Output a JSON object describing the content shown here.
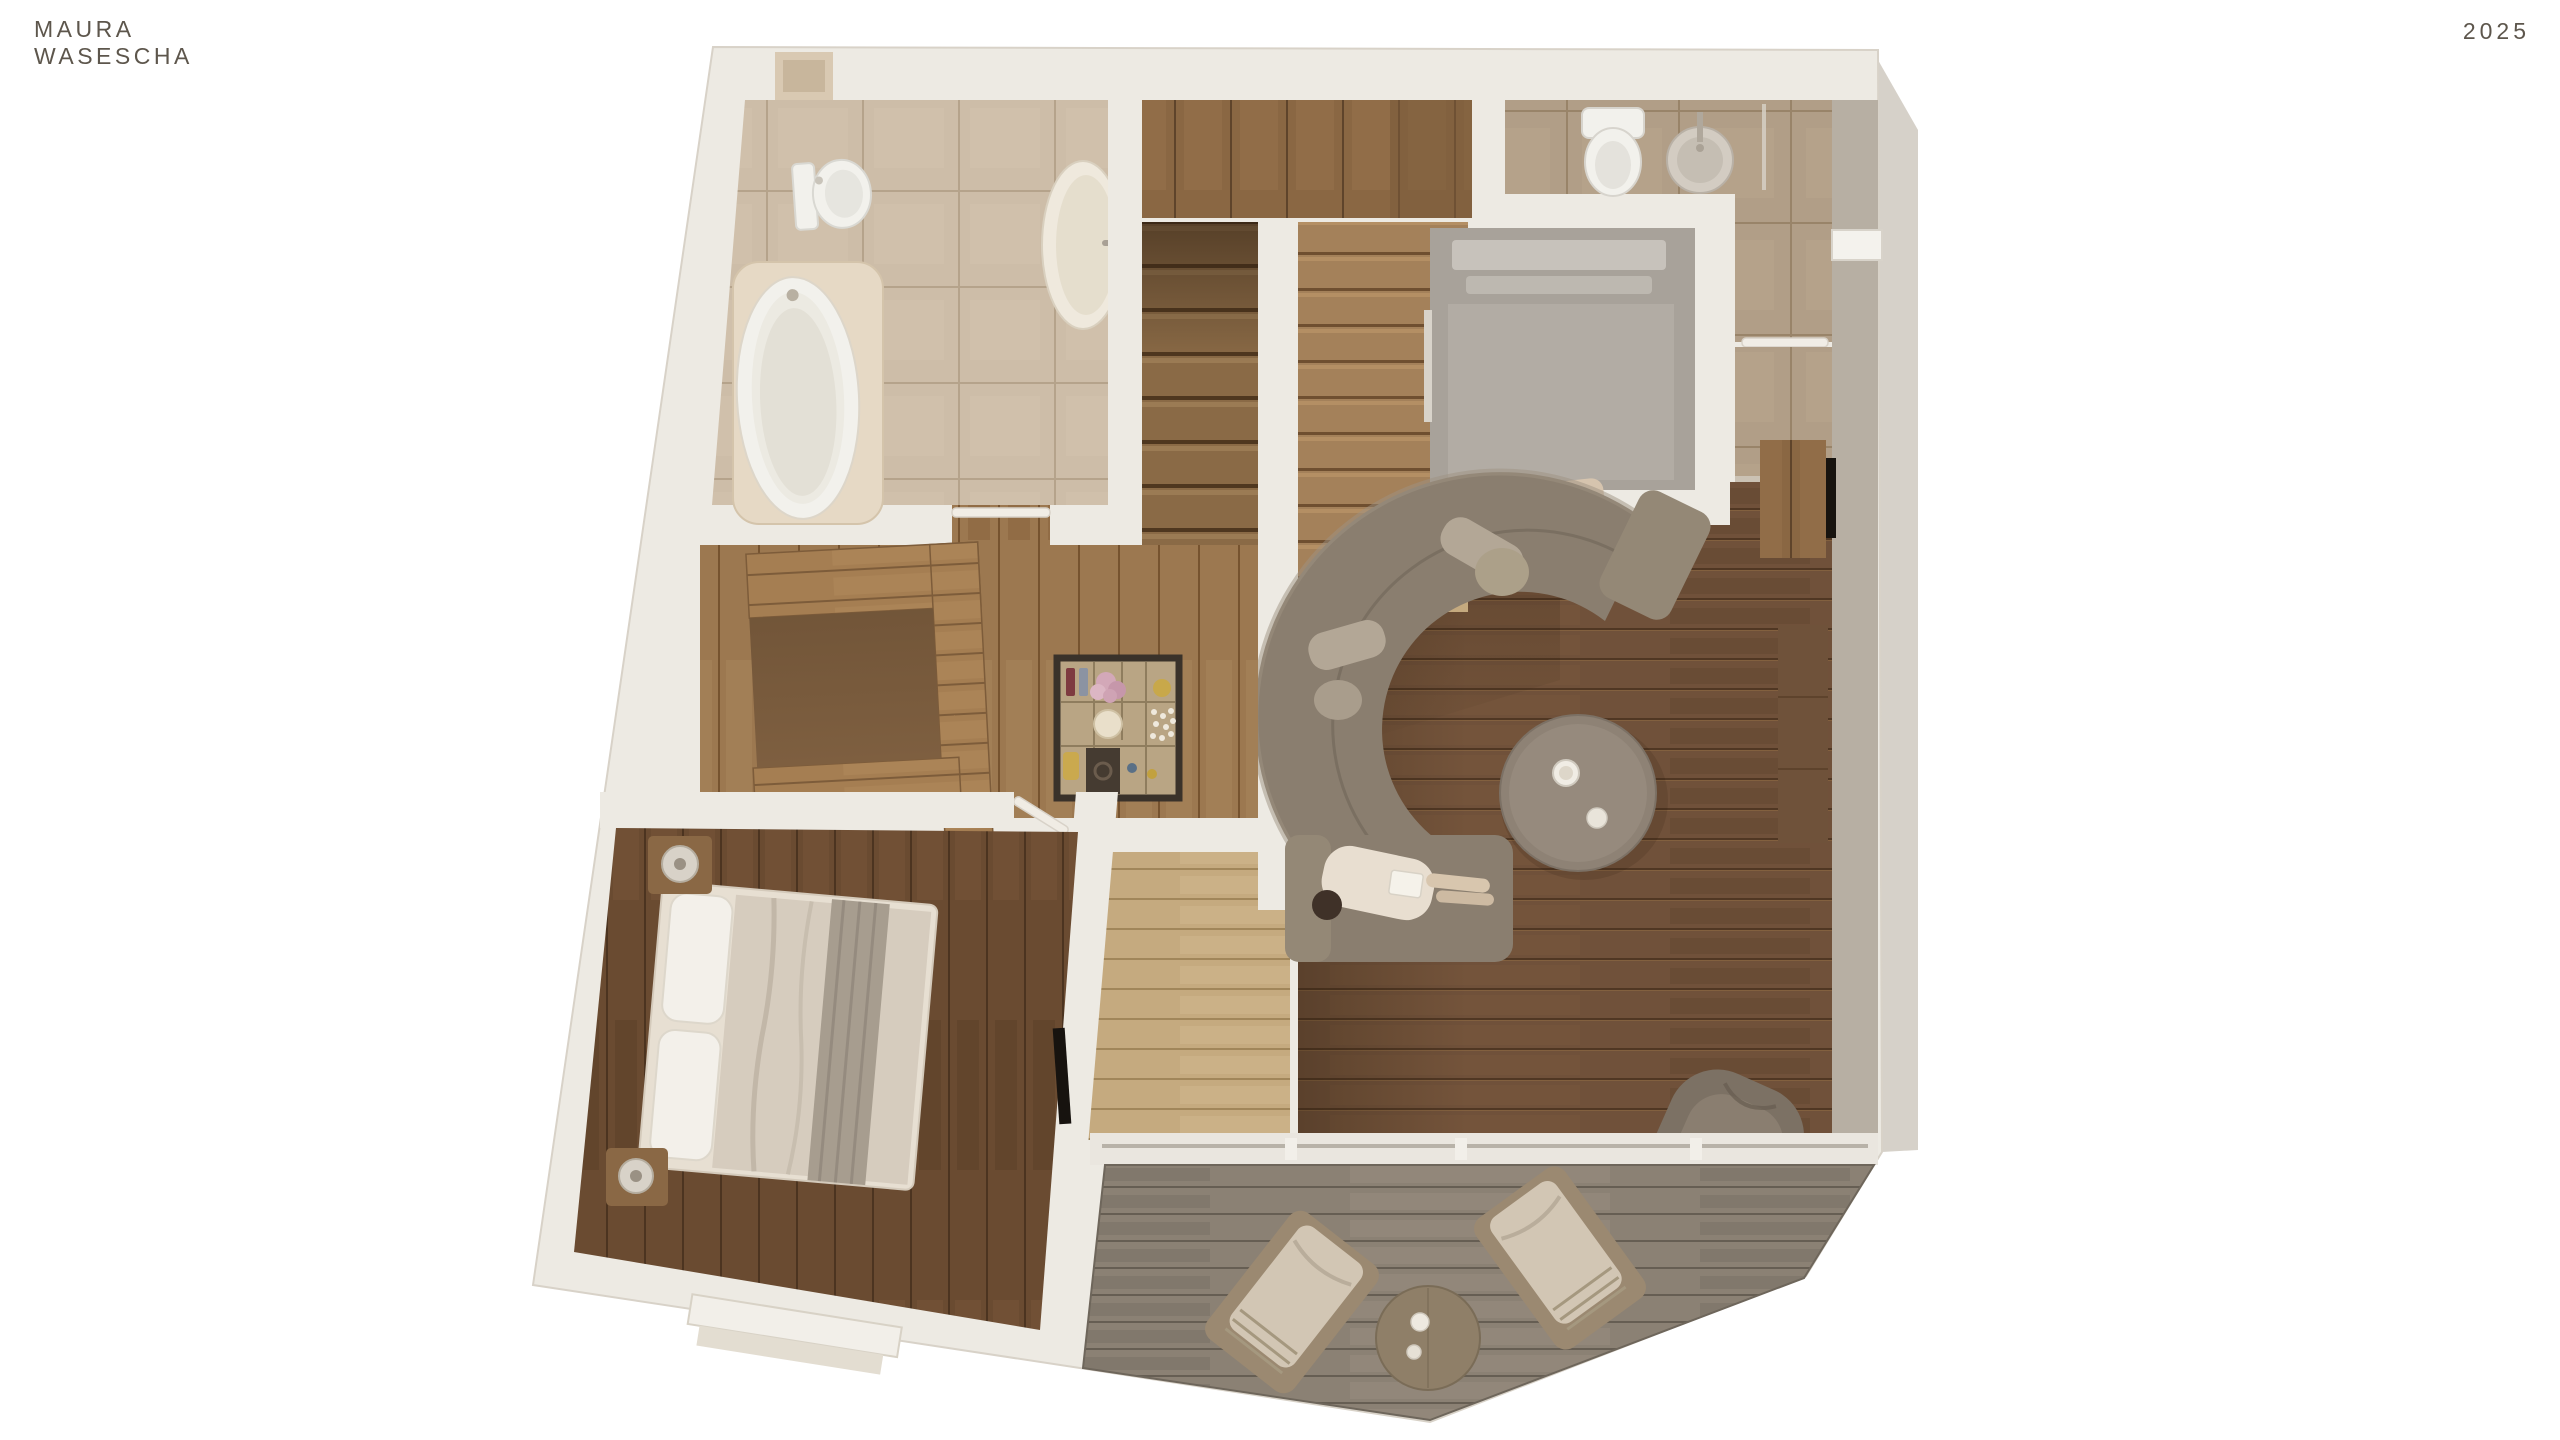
{
  "header": {
    "brand_line1": "MAURA",
    "brand_line2": "WASESCHA",
    "year": "2025"
  },
  "palette": {
    "bg": "#ffffff",
    "brand_color": "#5d564c",
    "wall": "#edeae3",
    "wall_shaded": "#b7afa3",
    "outer_shadow": "#d6d1c9",
    "living_floor": "#70513a",
    "pale_floor": "#c5aa7f",
    "hall_floor": "#9c7850",
    "bedroom_floor": "#6a4b31",
    "deck_floor": "#8b8174",
    "bath_tile": "#cdbda8",
    "shower_tile": "#b19e87",
    "cabinet_wood": "#8a6743",
    "island_wood": "#a57e52",
    "sofa": "#8a7e6f",
    "sofa_cushion": "#b3a796",
    "table": "#8e8275",
    "armchair": "#7c7164",
    "fixture_white": "#f2f1ec",
    "duvet": "#d6ccbe",
    "throw": "#a79d8f",
    "chair_cushion": "#d2c6b4",
    "flower_accent": "#d3a8b8",
    "tv_black": "#17130f"
  }
}
